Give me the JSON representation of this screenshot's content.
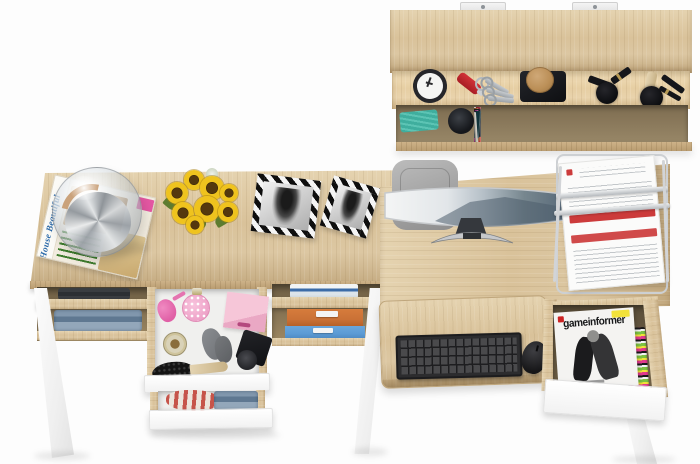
{
  "scene": {
    "width": 700,
    "height": 464
  },
  "colors": {
    "background": "#fdfdfd",
    "wood": "#d9c29a",
    "wood_light": "#e5d3b0",
    "wood_dark": "#c2a87e",
    "doc_red": "#cc3b3b",
    "chair_gray": "#a6a6a6",
    "perfume_pink": "#e060a6",
    "orange_box": "#ca7136",
    "blue_box": "#5b9bd5",
    "sunflower_yellow": "#efc31e",
    "sunflower_center": "#54380e",
    "cork_tan": "#bb8f57",
    "teal_item": "#3fae9e",
    "screen_sky": "#f2f3f4",
    "screen_mountain": "#5a6b7a"
  },
  "desk_left": {
    "magazine_title": "House Beautiful"
  },
  "desk_right": {
    "magazine_title": "gameinformer"
  },
  "shelf": {
    "book_spines": [
      "#d9d4c9",
      "#15171a",
      "#e8c21c",
      "#dfdbd2",
      "#2f6db8",
      "#101214",
      "#cfd6d2",
      "#27913c",
      "#8cc43d",
      "#17191c",
      "#45b8b0",
      "#202327",
      "#d6d2c8",
      "#144f2c",
      "#e0ddd5",
      "#101316",
      "#8d939a",
      "#0e1013",
      "#3a4047",
      "#d8d4ca",
      "#1d2125",
      "#2d3237",
      "#bf3a2d",
      "#121417",
      "#8e2030",
      "#5f1317",
      "#b5b1a8",
      "#c8c4bb",
      "#7d1a22",
      "#a03028",
      "#d5d1c7",
      "#8c5a2c",
      "#1a1d21",
      "#b03a8c",
      "#11333a",
      "#c0bcb2"
    ]
  }
}
